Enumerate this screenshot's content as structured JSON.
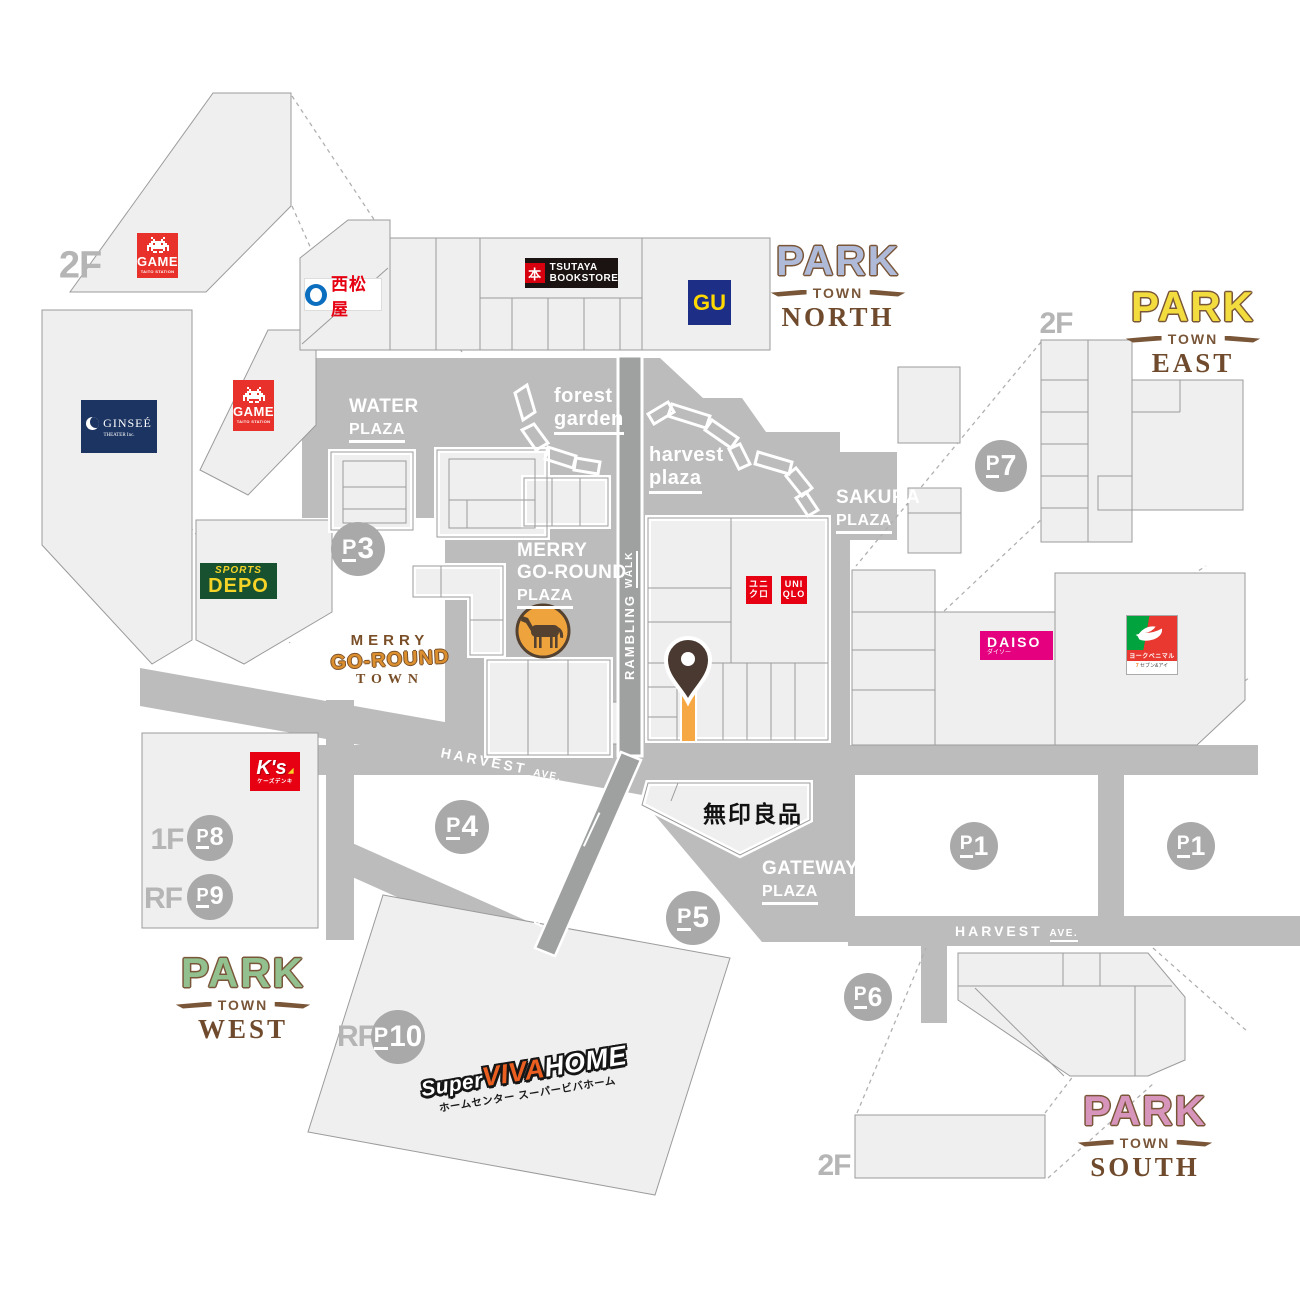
{
  "colors": {
    "road_gray": "#BCBCBC",
    "walk_gray": "#9FA0A0",
    "building_fill": "#EFEFEF",
    "building_outline": "#9B9B9B",
    "badge_gray": "#A9A9A9",
    "floor_label_gray": "#B5B5B5",
    "highlight_orange": "#F5A843",
    "pin_brown": "#493930",
    "park_north": "#AEBAD8",
    "park_east": "#F2DC3E",
    "park_west": "#93C08F",
    "park_south": "#D795BC",
    "logo_brown": "#7A5639"
  },
  "districts": {
    "north": {
      "park": "PARK",
      "town": "TOWN",
      "direction": "NORTH"
    },
    "east": {
      "park": "PARK",
      "town": "TOWN",
      "direction": "EAST"
    },
    "west": {
      "park": "PARK",
      "town": "TOWN",
      "direction": "WEST"
    },
    "south": {
      "park": "PARK",
      "town": "TOWN",
      "direction": "SOUTH"
    }
  },
  "plazas": {
    "water": {
      "name": "WATER",
      "sub": "PLAZA"
    },
    "forest": {
      "name": "forest",
      "sub": "garden"
    },
    "harvest": {
      "name": "harvest",
      "sub": "plaza"
    },
    "sakura": {
      "name": "SAKURA",
      "sub": "PLAZA"
    },
    "merry": {
      "line1": "MERRY",
      "line2": "GO-ROUND",
      "sub": "PLAZA"
    },
    "gateway": {
      "name": "GATEWAY",
      "sub": "PLAZA"
    }
  },
  "streets": {
    "harvest_ave": {
      "name": "HARVEST",
      "suffix": "AVE."
    },
    "rambling_walk": {
      "name": "RAMBLING",
      "suffix": "WALK"
    }
  },
  "parking": {
    "p1": {
      "p": "P",
      "n": "1"
    },
    "p3": {
      "p": "P",
      "n": "3"
    },
    "p4": {
      "p": "P",
      "n": "4"
    },
    "p5": {
      "p": "P",
      "n": "5"
    },
    "p6": {
      "p": "P",
      "n": "6"
    },
    "p7": {
      "p": "P",
      "n": "7"
    },
    "p8": {
      "p": "P",
      "n": "8"
    },
    "p9": {
      "p": "P",
      "n": "9"
    },
    "p10": {
      "p": "P",
      "n": "10"
    }
  },
  "floors": {
    "f1": "1F",
    "f2": "2F",
    "rf": "RF"
  },
  "town_logo": {
    "line1": "MERRY",
    "line2": "GO-ROUND",
    "line3": "TOWN"
  },
  "stores": {
    "game": {
      "name": "GAME",
      "sub": "TAITO STATION"
    },
    "nishimatsuya": {
      "name": "西松屋"
    },
    "ginsee": {
      "name": "GINSEÉ",
      "sub": "THEATER Inc."
    },
    "sports_depo": {
      "line1": "SPORTS",
      "line2": "DEPO"
    },
    "tsutaya": {
      "line1": "TSUTAYA",
      "line2": "BOOKSTORE"
    },
    "gu": {
      "name": "GU"
    },
    "uniqlo_jp": {
      "line1": "ユニ",
      "line2": "クロ"
    },
    "uniqlo_en": {
      "line1": "UNI",
      "line2": "QLO"
    },
    "daiso": {
      "name": "DAISO",
      "sub": "ダイソー"
    },
    "york_benimaru": {
      "name": "ヨークベニマル",
      "sub": "セブン&アイ"
    },
    "ks_denki": {
      "name": "K's",
      "sub": "ケーズデンキ"
    },
    "muji": {
      "name": "無印良品"
    },
    "viva_home": {
      "line1_a": "Super",
      "line1_b": "VIVA",
      "line1_c": "HOME",
      "line2": "ホームセンター スーパービバホーム"
    }
  }
}
